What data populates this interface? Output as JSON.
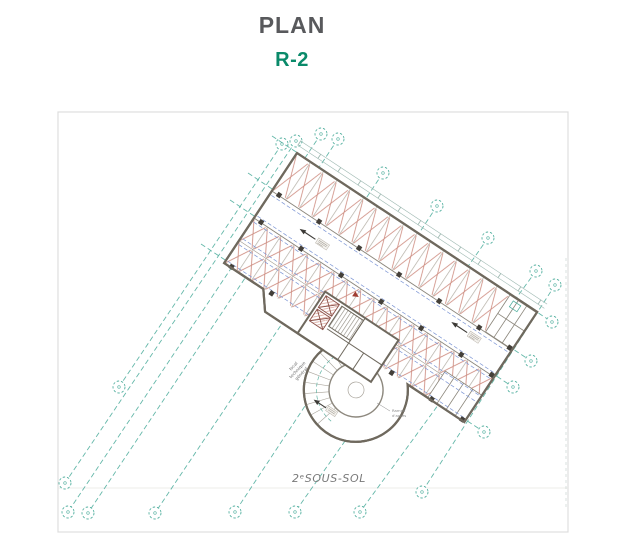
{
  "title": "PLAN",
  "subtitle": "R-2",
  "plan": {
    "level_label": "2ᵉSOUS-SOL",
    "technical_room_label_lines": [
      "local",
      "technique",
      "général"
    ],
    "ramp_note_lines": [
      "Rampe",
      "d'accès"
    ],
    "colors": {
      "title_text": "#58595c",
      "accent_teal": "#0a8a6a",
      "grid_teal": "#54b0a0",
      "wall": "#6f695e",
      "stall_red": "#cd8a7e",
      "aisle_dash_blue": "#7c95d4",
      "frame": "#dedede",
      "annotation_gray": "#7a7a7a"
    }
  }
}
